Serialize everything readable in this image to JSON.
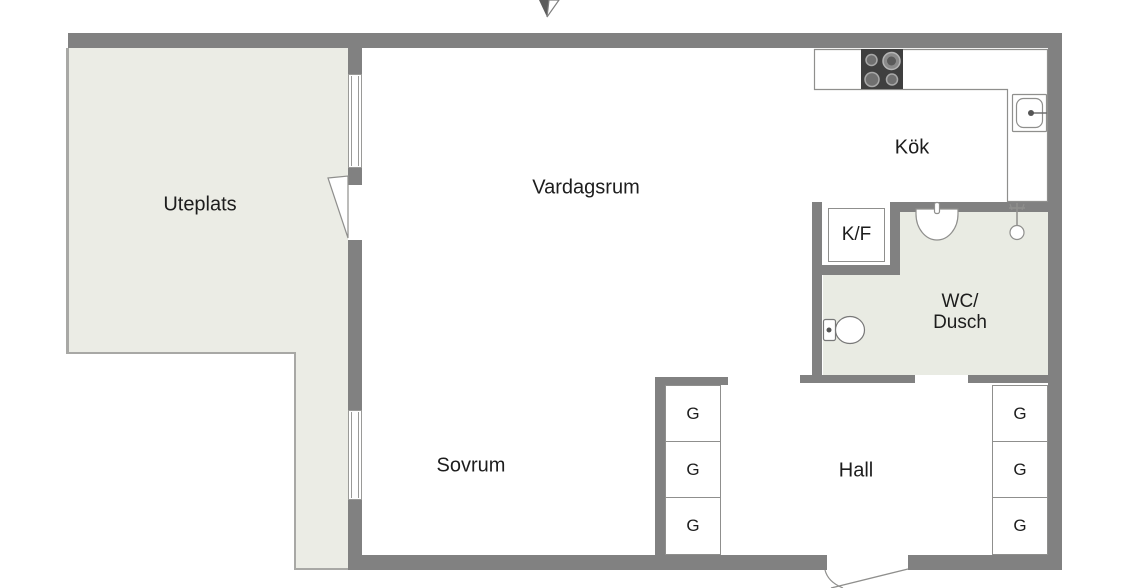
{
  "floorplan": {
    "rooms": {
      "uteplats": "Uteplats",
      "vardagsrum": "Vardagsrum",
      "kok": "Kök",
      "sovrum": "Sovrum",
      "hall": "Hall",
      "wc_dusch_line1": "WC/",
      "wc_dusch_line2": "Dusch"
    },
    "fixtures": {
      "fridge_freezer": "K/F",
      "closet": "G"
    },
    "icons": [
      "north-arrow-icon",
      "stove-icon",
      "kitchen-sink-icon",
      "bathroom-sink-icon",
      "shower-icon",
      "toilet-icon",
      "window-icon",
      "door-swing-icon"
    ],
    "colors": {
      "wall": "#818181",
      "patio_fill": "#ebece5",
      "bath_fill": "#e9ebe3",
      "thin_line": "#8f8f8d",
      "stove": "#3f3f3f",
      "text": "#1d1d1d",
      "background": "#ffffff"
    }
  }
}
